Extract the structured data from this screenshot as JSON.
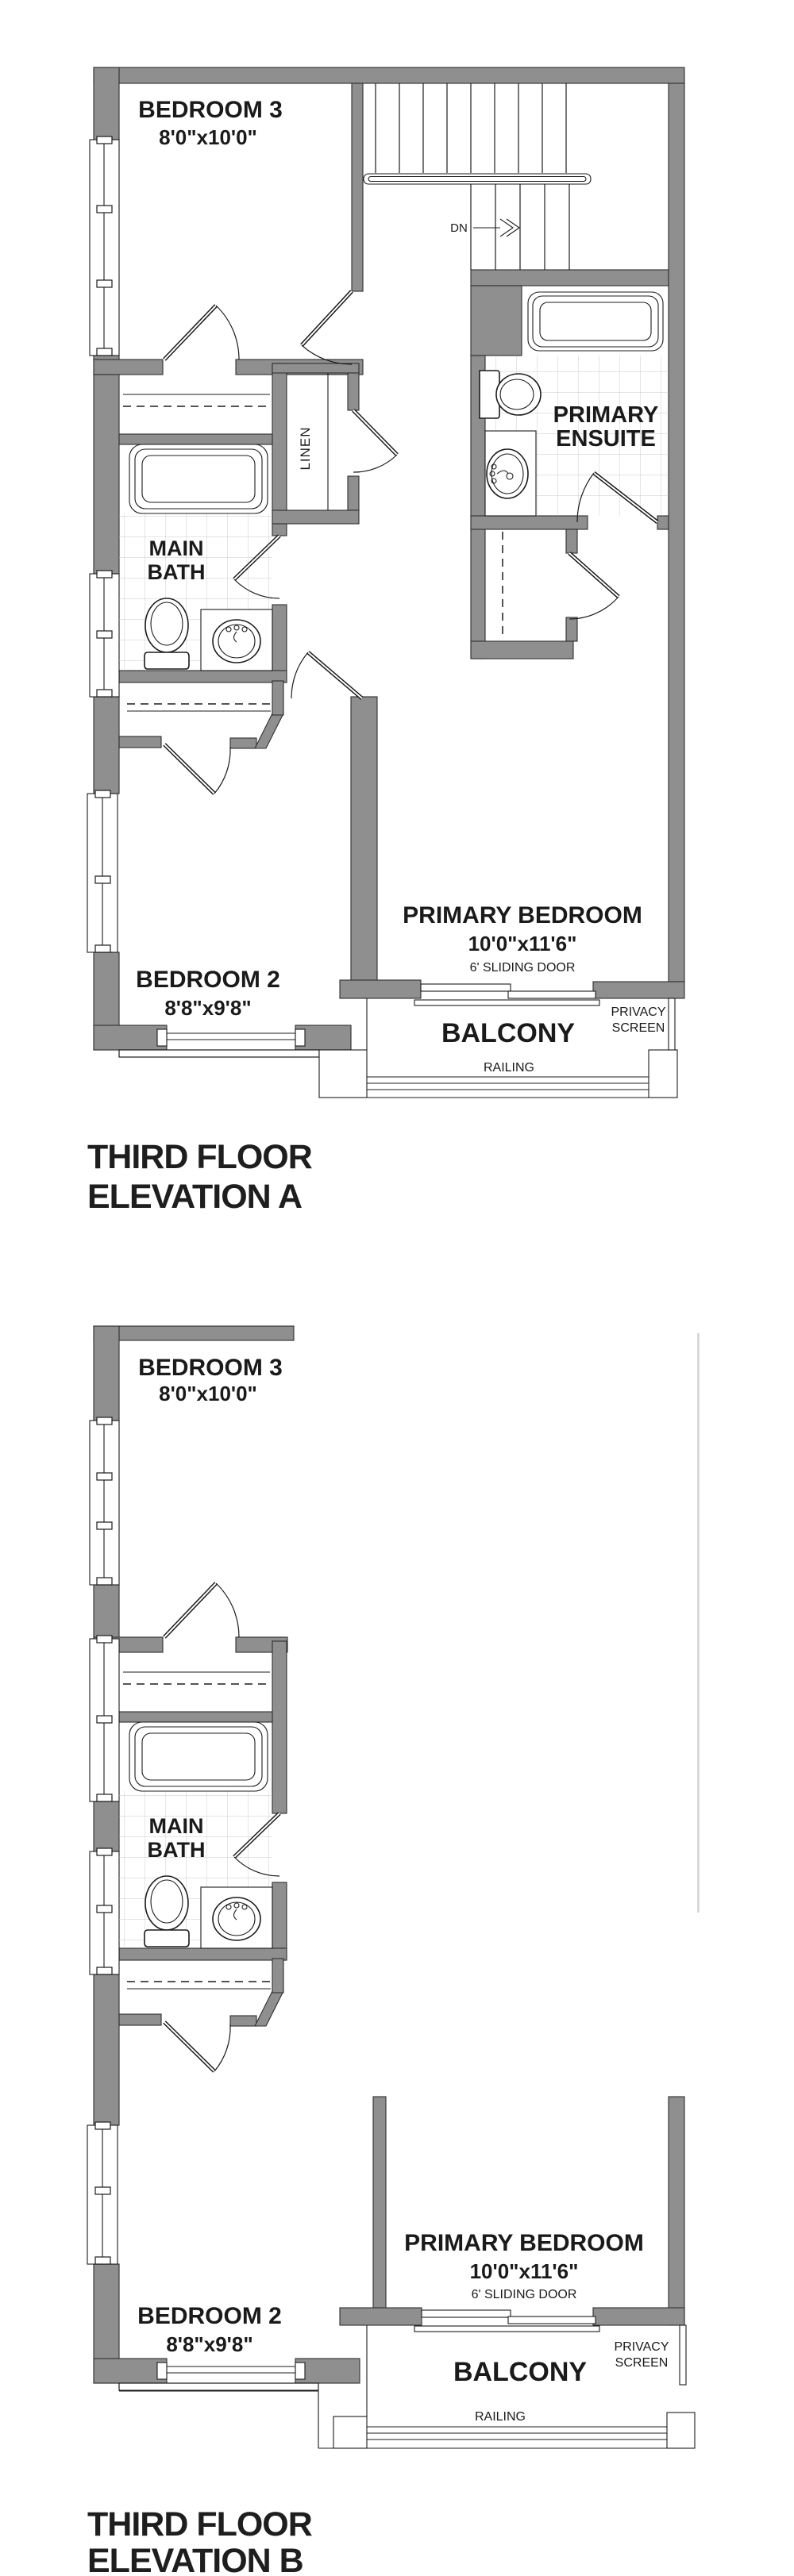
{
  "colors": {
    "background": "#ffffff",
    "wall_gray": "#8f8f8f",
    "line_black": "#1c1c1c",
    "tile_gray": "#c9c9c9",
    "faint_gray": "#d9d9d9",
    "text": "#1a1a1a"
  },
  "plans": [
    {
      "name": "Third Floor Elevation A",
      "title": {
        "line1": "THIRD FLOOR",
        "line2": "ELEVATION A"
      },
      "rooms": {
        "bedroom3": {
          "label": "BEDROOM 3",
          "dims": "8'0\"x10'0\""
        },
        "bedroom2": {
          "label": "BEDROOM 2",
          "dims": "8'8\"x9'8\""
        },
        "primary_bedroom": {
          "label": "PRIMARY BEDROOM",
          "dims": "10'0\"x11'6\"",
          "note": "6' SLIDING DOOR"
        },
        "primary_ensuite": {
          "label_line1": "PRIMARY",
          "label_line2": "ENSUITE"
        },
        "main_bath": {
          "label_line1": "MAIN",
          "label_line2": "BATH"
        },
        "linen": {
          "label": "LINEN"
        }
      },
      "stairs": {
        "down_label": "DN"
      },
      "balcony": {
        "label": "BALCONY",
        "railing_label": "RAILING",
        "privacy_line1": "PRIVACY",
        "privacy_line2": "SCREEN"
      }
    },
    {
      "name": "Third Floor Elevation B",
      "title": {
        "line1": "THIRD FLOOR",
        "line2": "ELEVATION B"
      },
      "rooms": {
        "bedroom3": {
          "label": "BEDROOM 3",
          "dims": "8'0\"x10'0\""
        },
        "bedroom2": {
          "label": "BEDROOM 2",
          "dims": "8'8\"x9'8\""
        },
        "primary_bedroom": {
          "label": "PRIMARY BEDROOM",
          "dims": "10'0\"x11'6\"",
          "note": "6' SLIDING DOOR"
        },
        "main_bath": {
          "label_line1": "MAIN",
          "label_line2": "BATH"
        }
      },
      "balcony": {
        "label": "BALCONY",
        "railing_label": "RAILING",
        "privacy_line1": "PRIVACY",
        "privacy_line2": "SCREEN"
      }
    }
  ]
}
